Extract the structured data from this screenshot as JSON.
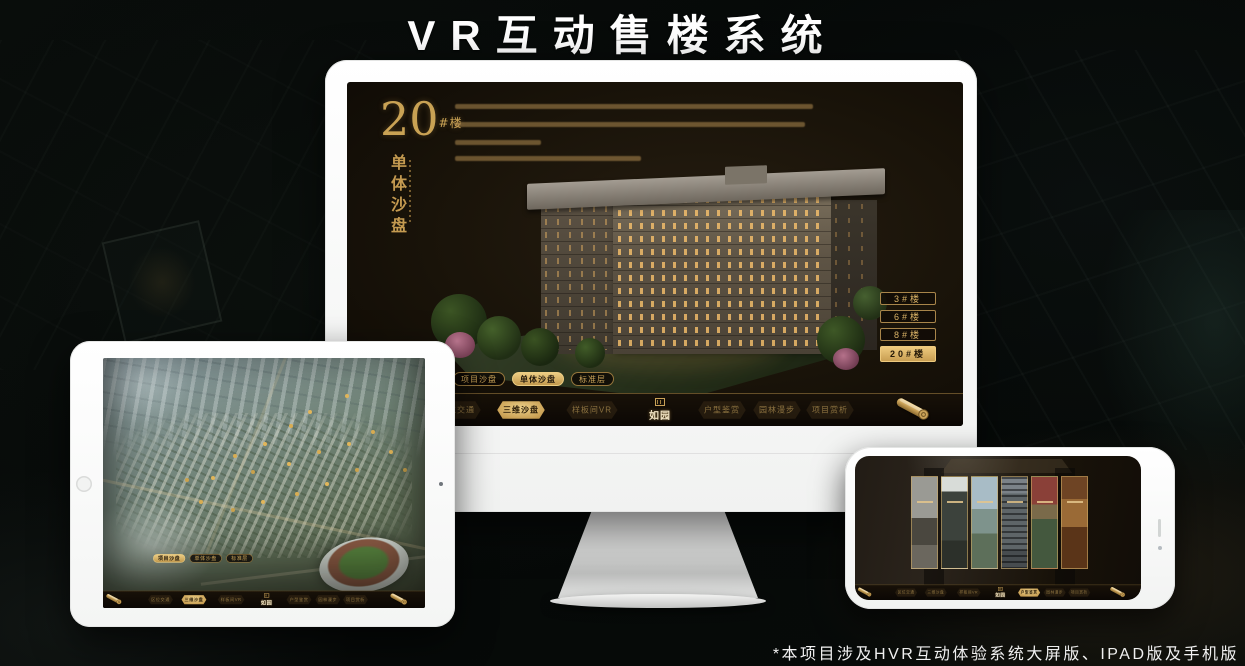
{
  "page": {
    "title": "VR互动售楼系统",
    "footnote": "*本项目涉及HVR互动体验系统大屏版、IPAD版及手机版"
  },
  "app_nav": {
    "logo": "如园",
    "logo_seal_icon": "seal-icon",
    "scroll_icon": "scroll-icon",
    "items": [
      "区位交通",
      "三维沙盘",
      "样板间VR",
      "户型鉴赏",
      "园林漫步",
      "项目赏析"
    ],
    "mode_tabs": [
      "项目沙盘",
      "单体沙盘",
      "标准层"
    ]
  },
  "monitor_ui": {
    "headline_number": "20",
    "headline_unit": "#楼",
    "headline_subtitle": "单体沙盘",
    "active_mode": "单体沙盘",
    "active_nav": "三维沙盘",
    "floor_buttons": [
      "3#楼",
      "6#楼",
      "8#楼",
      "20#楼"
    ],
    "active_floor": "20#楼"
  },
  "tablet_ui": {
    "active_mode": "项目沙盘",
    "active_nav": "三维沙盘"
  },
  "phone_ui": {
    "active_nav": "户型鉴赏"
  },
  "colors": {
    "gold": "#c9a254",
    "gold_bright": "#ecd08a",
    "active_pill_text": "#241a0c",
    "screen_bg": "#191309"
  }
}
